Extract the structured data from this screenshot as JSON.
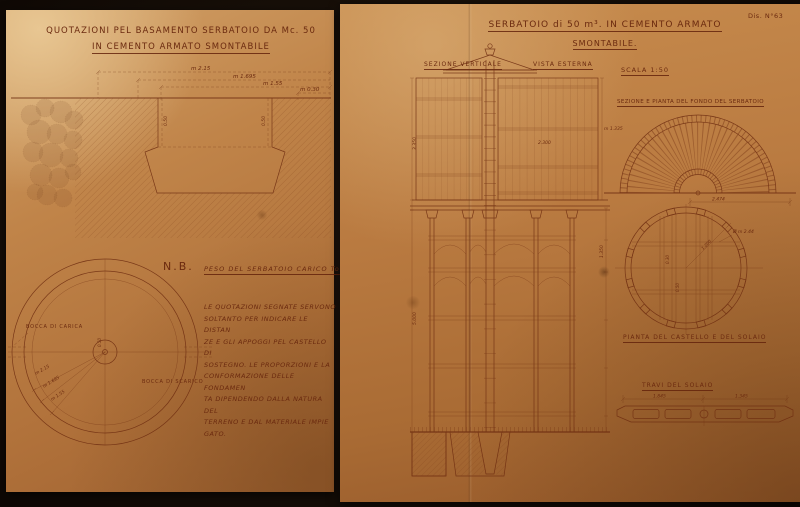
{
  "scene": {
    "description": "Two aged sepia engineering drawing sheets for a 50 cubic metre demountable reinforced-concrete water tank"
  },
  "colors": {
    "ink": "#6e2c10",
    "paper_left": "#c08449",
    "paper_right": "#b5773f",
    "background": "#170f08"
  },
  "left_sheet": {
    "title1": "QUOTAZIONI PEL BASAMENTO SERBATOIO DA Mc. 50",
    "title2": "IN CEMENTO ARMATO SMONTABILE",
    "section": {
      "d1": "m 2.15",
      "d2": "m 1.695",
      "d3": "m 1.55",
      "d4": "m 0.30",
      "w1": "0.50",
      "w2": "0.50"
    },
    "nb_label": "N.B.",
    "nb_text": "PESO DEL SERBATOIO CARICO Tonn.",
    "note": {
      "lines": [
        "LE QUOTAZIONI SEGNATE SERVONO",
        "SOLTANTO PER INDICARE LE DISTAN",
        "ZE E GLI APPOGGI PEL CASTELLO DI",
        "SOSTEGNO. LE PROPORZIONI E LA",
        "CONFORMAZIONE DELLE FONDAMEN",
        "TA DIPENDENDO DALLA NATURA DEL",
        "TERRENO E DAL MATERIALE IMPIE",
        "GATO."
      ]
    },
    "plan": {
      "bocca_carica": "BOCCA DI CARICA",
      "bocca_scarico": "BOCCA DI SCARICO",
      "r1": "m 2.15",
      "r2": "m 1.695",
      "r3": "m 1.55",
      "center_dim": "0.50"
    }
  },
  "right_sheet": {
    "drawing_no": "Dis. N°63",
    "title1": "SERBATOIO di 50 m³. IN CEMENTO ARMATO",
    "title2": "SMONTABILE.",
    "label_sezione": "SEZIONE VERTICALE",
    "label_vista": "VISTA ESTERNA",
    "label_scala": "SCALA 1:50",
    "label_fondo": "SEZIONE E PIANTA DEL FONDO DEL SERBATOIO",
    "label_castello": "PIANTA DEL CASTELLO E DEL SOLAIO",
    "label_travi": "TRAVI DEL SOLAIO",
    "tower": {
      "dim_left_upper": "3.350",
      "dim_left_lower": "5.000",
      "dim_center": "2.300",
      "dim_right": "1.350"
    },
    "fondo": {
      "dim": "2.474",
      "radius_label": "m 1.335"
    },
    "castello": {
      "diameter": "Ø m 2.44",
      "radius": "1.200",
      "d1": "0.30",
      "d2": "0.50"
    },
    "travi": {
      "d1": "1.845",
      "d2": "1.345"
    }
  }
}
